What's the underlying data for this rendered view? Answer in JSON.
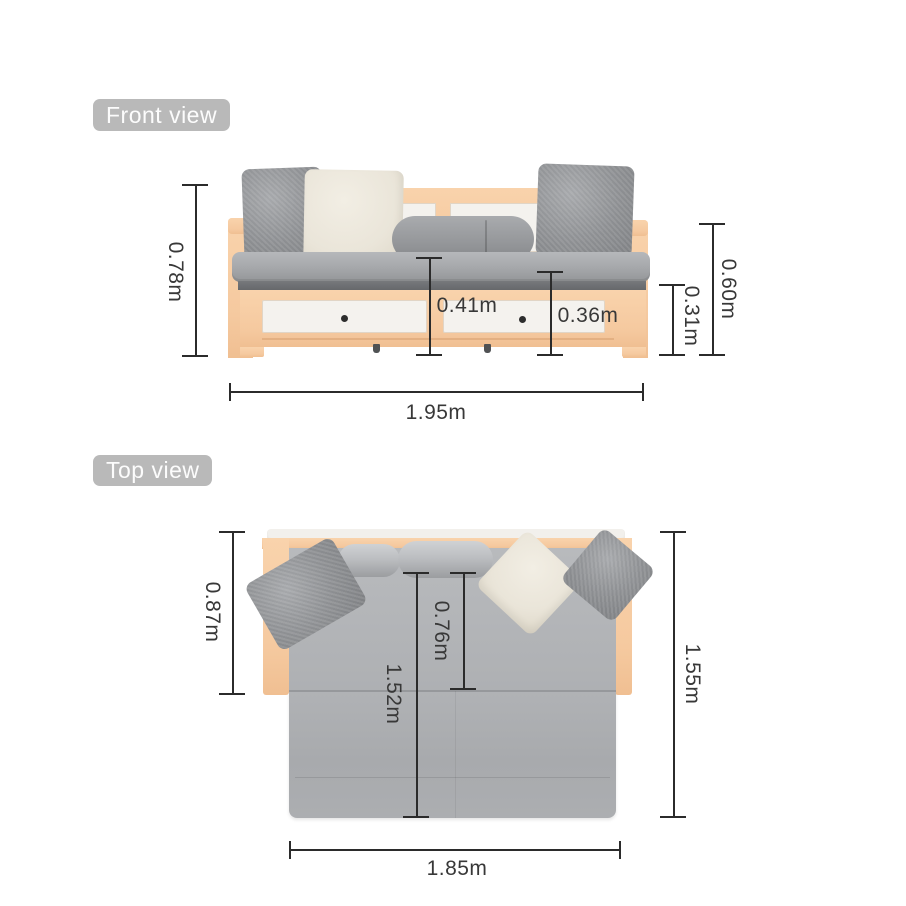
{
  "front_view": {
    "badge": "Front view",
    "dimensions": {
      "overall_height": "0.78m",
      "seat_platform_height": "0.41m",
      "cushion_top_height": "0.36m",
      "base_height": "0.31m",
      "arm_height": "0.60m",
      "overall_width": "1.95m"
    }
  },
  "top_view": {
    "badge": "Top view",
    "dimensions": {
      "seat_section_depth": "0.87m",
      "cushion_section_depth": "0.76m",
      "bed_length": "1.52m",
      "overall_depth": "1.55m",
      "bed_width": "1.85m"
    }
  },
  "colors": {
    "wood_frame": "#f6cba3",
    "seat_cushion_gray": "#a7a9ac",
    "pillow_dark_gray": "#8d8f92",
    "pillow_cream": "#ece8dd",
    "mattress_gray": "#b0b2b5",
    "drawer_white": "#f4f2ee",
    "dimension_line": "#2b2b2b",
    "badge_background": "#b9b9b9",
    "badge_text": "#ffffff"
  }
}
